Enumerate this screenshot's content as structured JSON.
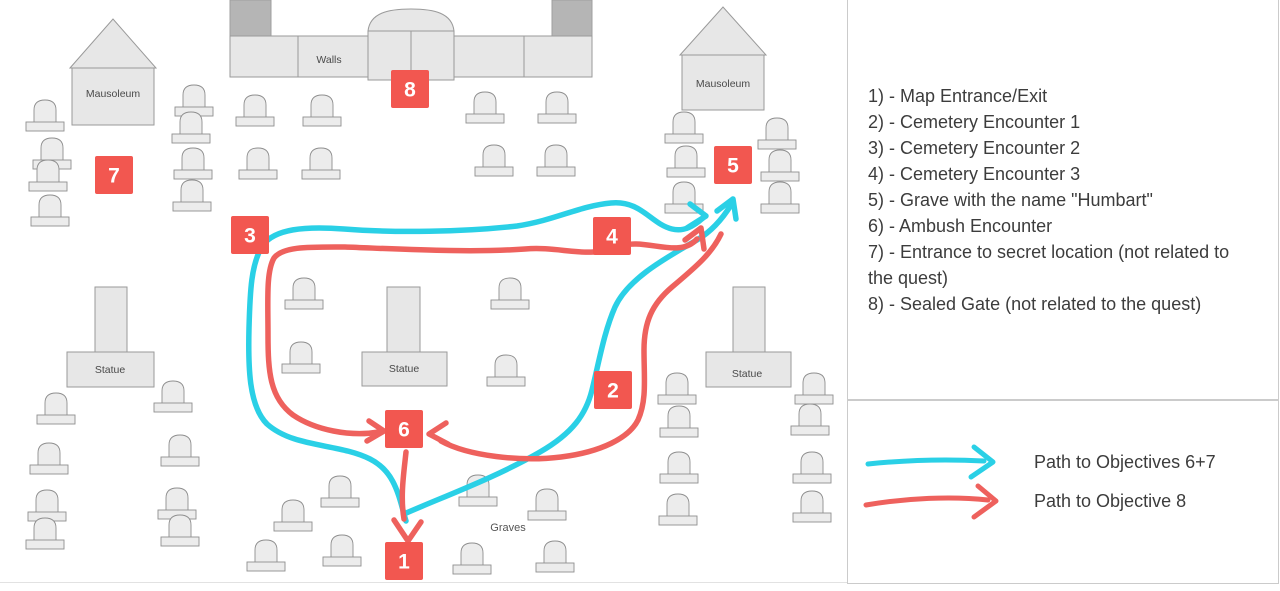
{
  "map": {
    "labels": {
      "mausoleum": "Mausoleum",
      "walls": "Walls",
      "statue": "Statue",
      "graves": "Graves"
    },
    "colors": {
      "marker": "#f25750",
      "cyan": "#2ad0e6",
      "red": "#ee615d"
    },
    "markers": [
      {
        "n": "1",
        "x": 404,
        "y": 561
      },
      {
        "n": "2",
        "x": 613,
        "y": 390
      },
      {
        "n": "3",
        "x": 250,
        "y": 235
      },
      {
        "n": "4",
        "x": 612,
        "y": 236
      },
      {
        "n": "5",
        "x": 733,
        "y": 165
      },
      {
        "n": "6",
        "x": 404,
        "y": 429
      },
      {
        "n": "7",
        "x": 114,
        "y": 175
      },
      {
        "n": "8",
        "x": 410,
        "y": 89
      }
    ],
    "gravestones": [
      [
        45,
        100
      ],
      [
        52,
        138
      ],
      [
        48,
        160
      ],
      [
        50,
        195
      ],
      [
        194,
        85
      ],
      [
        191,
        112
      ],
      [
        193,
        148
      ],
      [
        192,
        180
      ],
      [
        255,
        95
      ],
      [
        322,
        95
      ],
      [
        258,
        148
      ],
      [
        321,
        148
      ],
      [
        485,
        92
      ],
      [
        557,
        92
      ],
      [
        494,
        145
      ],
      [
        556,
        145
      ],
      [
        684,
        112
      ],
      [
        686,
        146
      ],
      [
        684,
        182
      ],
      [
        777,
        118
      ],
      [
        780,
        150
      ],
      [
        780,
        182
      ],
      [
        304,
        278
      ],
      [
        510,
        278
      ],
      [
        301,
        342
      ],
      [
        506,
        355
      ],
      [
        56,
        393
      ],
      [
        49,
        443
      ],
      [
        47,
        490
      ],
      [
        45,
        518
      ],
      [
        173,
        381
      ],
      [
        180,
        435
      ],
      [
        177,
        488
      ],
      [
        180,
        515
      ],
      [
        266,
        540
      ],
      [
        342,
        535
      ],
      [
        340,
        476
      ],
      [
        293,
        500
      ],
      [
        478,
        475
      ],
      [
        547,
        489
      ],
      [
        472,
        543
      ],
      [
        555,
        541
      ],
      [
        677,
        373
      ],
      [
        679,
        406
      ],
      [
        679,
        452
      ],
      [
        678,
        494
      ],
      [
        814,
        373
      ],
      [
        810,
        404
      ],
      [
        812,
        452
      ],
      [
        812,
        491
      ]
    ],
    "routes": [
      {
        "name": "cyan-route-main-loop",
        "color": "cyan",
        "d": "M 406 521 C 399 498 396 472 370 459 C 338 443 294 448 267 424 C 249 406 248 368 249 328 C 250 292 251 263 263 245 C 275 229 304 226 344 229 C 394 233 463 232 517 226 C 556 220 579 206 611 203 C 641 200 651 224 672 229 C 684 232 694 226 703 218"
      },
      {
        "name": "cyan-arrowhead-right-at-5",
        "color": "cyan",
        "d": "M 690 204 L 706 216 L 687 228"
      },
      {
        "name": "cyan-route-right-branch",
        "color": "cyan",
        "d": "M 404 514 C 440 498 495 478 540 452 C 573 433 586 414 592 390 C 599 362 604 332 615 307 C 627 281 658 262 697 240 C 712 231 723 218 731 205"
      },
      {
        "name": "cyan-arrowhead-up-at-5",
        "color": "cyan",
        "d": "M 736 219 L 733 199 L 717 211"
      },
      {
        "name": "red-route-inner-loop",
        "color": "red",
        "d": "M 379 432 C 350 437 315 430 293 415 C 270 398 268 372 268 335 C 268 300 266 272 274 258 C 283 246 310 247 345 247 C 400 249 470 253 525 249 C 560 246 588 259 617 247 C 645 236 678 260 697 239"
      },
      {
        "name": "red-arrowhead-up-at-5",
        "color": "red",
        "d": "M 704 249 L 701 228 L 685 240"
      },
      {
        "name": "red-route-right-branch",
        "color": "red",
        "d": "M 721 234 C 712 253 697 266 672 287 C 652 304 644 322 644 350 C 644 378 647 400 638 420 C 629 438 601 452 561 457 C 521 462 468 456 441 441"
      },
      {
        "name": "red-arrowhead-into-6-from-right",
        "color": "red",
        "d": "M 446 423 L 429 434 L 448 444"
      },
      {
        "name": "red-arrowhead-into-6-from-left",
        "color": "red",
        "d": "M 369 421 L 384 431 L 367 441"
      },
      {
        "name": "red-route-6-to-1",
        "color": "red",
        "d": "M 406 452 C 404 472 400 496 404 519"
      },
      {
        "name": "red-arrowhead-down-at-1",
        "color": "red",
        "d": "M 394 520 L 408 541 L 421 522"
      }
    ]
  },
  "panel": {
    "objectives": [
      "1) - Map Entrance/Exit",
      "2) - Cemetery Encounter 1",
      "3) - Cemetery Encounter 2",
      "4) - Cemetery Encounter 3",
      "5) - Grave with the name \"Humbart\"",
      "6) - Ambush Encounter",
      "7) - Entrance to secret location (not related to the quest)",
      "8) - Sealed Gate (not related to the quest)"
    ],
    "legend": [
      {
        "label": "Path to Objectives 6+7"
      },
      {
        "label": "Path to Objective 8"
      }
    ]
  }
}
